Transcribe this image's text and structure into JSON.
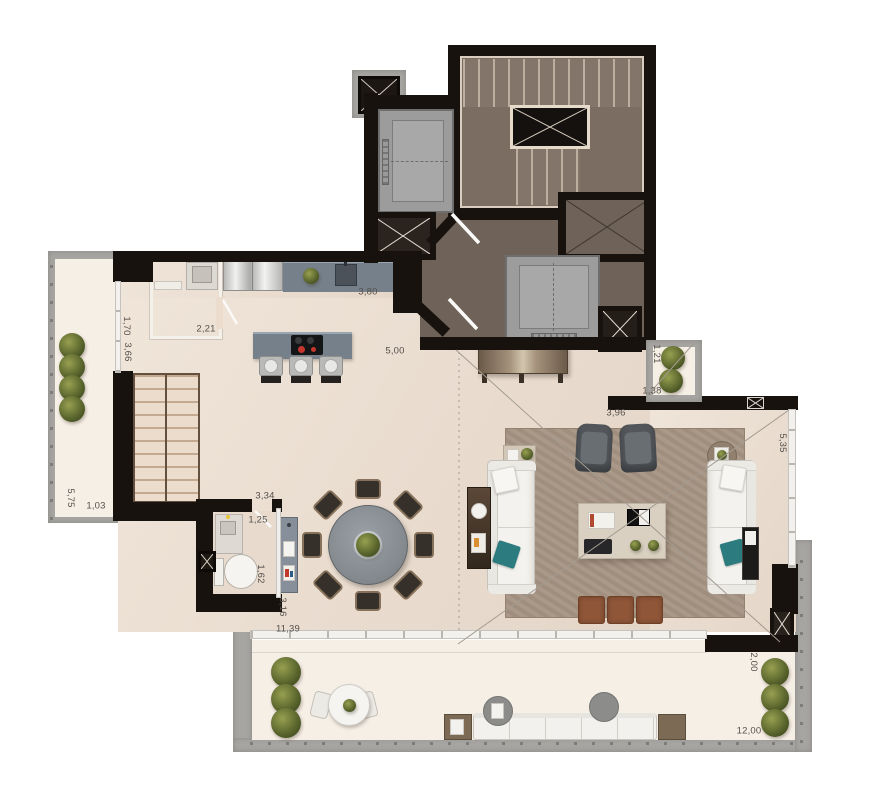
{
  "plan": {
    "dimensions": [
      {
        "text": "3,80"
      },
      {
        "text": "5,00"
      },
      {
        "text": "2,21"
      },
      {
        "text": "1,70"
      },
      {
        "text": "3,66"
      },
      {
        "text": "1,21"
      },
      {
        "text": "1,38"
      },
      {
        "text": "3,96"
      },
      {
        "text": "5,35"
      },
      {
        "text": "5,75"
      },
      {
        "text": "1,03"
      },
      {
        "text": "3,34"
      },
      {
        "text": "1,25"
      },
      {
        "text": "1,62"
      },
      {
        "text": "3,16"
      },
      {
        "text": "11,39"
      },
      {
        "text": "2,00"
      },
      {
        "text": "12,00"
      }
    ],
    "colors": {
      "wall": "#17120e",
      "core_floor": "#6f6258",
      "interior_floor": "#ebdccd",
      "terrace_floor": "#f6efe6",
      "concrete_border": "#a7a5a2",
      "counter_stone": "#76808b",
      "rug": "#a59483",
      "sofa": "#f3f2ee",
      "accent_teal": "#2c7b7e",
      "leather_ottoman": "#8f5638",
      "dining_table": "#888d92",
      "wood": "#7c6a55",
      "plant_green": "#5c672e",
      "elevator_gray": "#9c9c9c",
      "dimension_text": "#55504b"
    }
  }
}
